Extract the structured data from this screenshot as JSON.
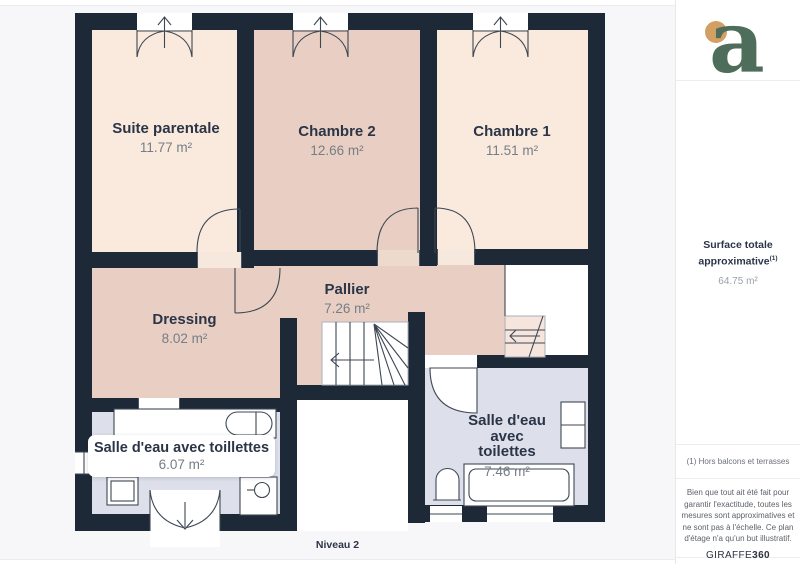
{
  "plan": {
    "level_label": "Niveau 2"
  },
  "rooms": [
    {
      "id": "suite-parentale",
      "name": "Suite parentale",
      "area": "11.77 m²"
    },
    {
      "id": "chambre-2",
      "name": "Chambre 2",
      "area": "12.66 m²"
    },
    {
      "id": "chambre-1",
      "name": "Chambre 1",
      "area": "11.51 m²"
    },
    {
      "id": "pallier",
      "name": "Pallier",
      "area": "7.26 m²"
    },
    {
      "id": "dressing",
      "name": "Dressing",
      "area": "8.02 m²"
    },
    {
      "id": "salle-eau-1",
      "name": "Salle d'eau avec toillettes",
      "area": "6.07 m²"
    },
    {
      "id": "salle-eau-2",
      "name": "Salle d'eau avec toilettes",
      "area": "7.46 m²"
    }
  ],
  "sidebar": {
    "logo_letter": "a",
    "surface_label_line1": "Surface totale",
    "surface_label_line2": "approximative",
    "surface_footnote_ref": "(1)",
    "surface_value": "64.75 m²",
    "footnote": "(1) Hors balcons et terrasses",
    "disclaimer": "Bien que tout ait été fait pour garantir l'exactitude, toutes les mesures sont approximatives et ne sont pas à l'échelle. Ce plan d'étage n'a qu'un but illustratif.",
    "brand": "GIRAFFE",
    "brand_bold": "360"
  },
  "colors": {
    "wall": "#1d2937",
    "room_cream": "#faeadd",
    "room_pink": "#e9cfc3",
    "room_lavender": "#dde0ea",
    "line": "#3e4754",
    "text_dark": "#2b3547",
    "text_gray": "#767d87",
    "logo_green": "#4e6e5b",
    "logo_orange": "#d49f62"
  }
}
